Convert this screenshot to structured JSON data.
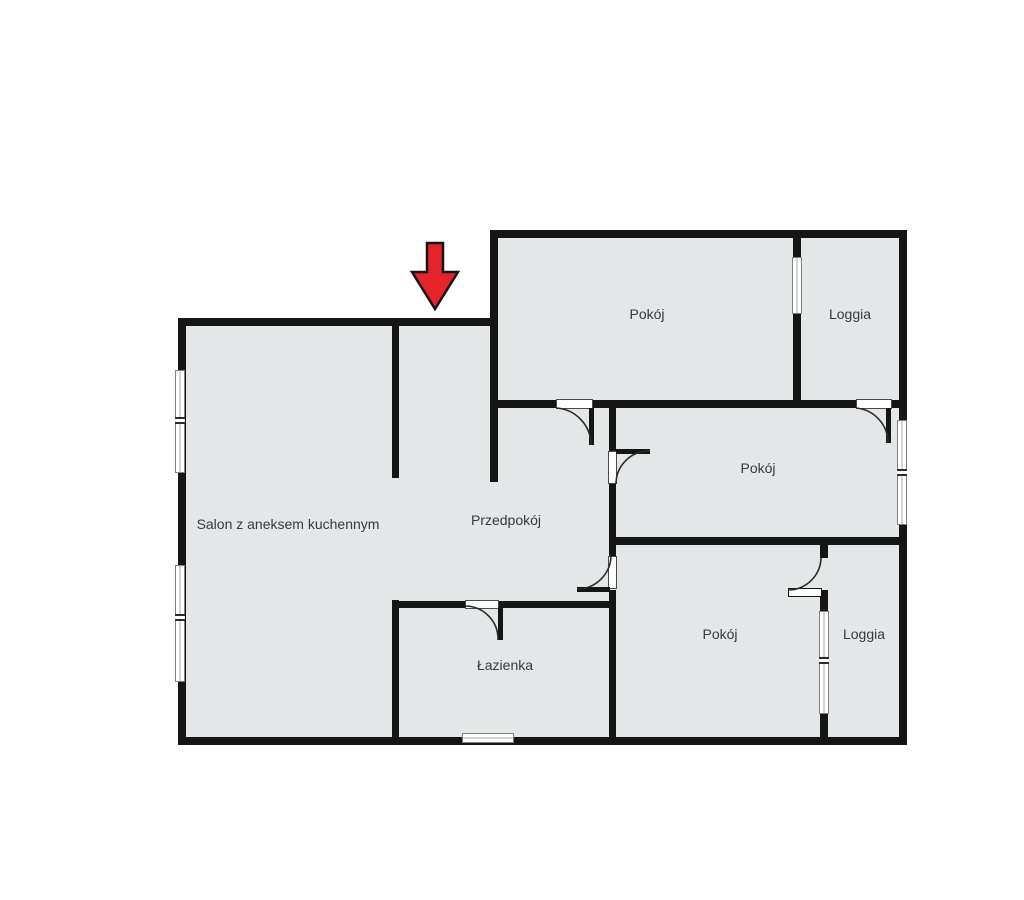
{
  "colors": {
    "background": "#ffffff",
    "floor": "#e4e7e8",
    "wall": "#151515",
    "label": "#35393d",
    "arc": "#2a2a2a",
    "window_border": "#808080",
    "door_border": "#4a4a4a",
    "arrow_fill": "#e5232b",
    "arrow_outline": "#151515"
  },
  "rooms": {
    "salon": {
      "label": "Salon z aneksem kuchennym"
    },
    "przedpokoj": {
      "label": "Przedpokój"
    },
    "lazienka": {
      "label": "Łazienka"
    },
    "pokoj_top": {
      "label": "Pokój"
    },
    "loggia_top": {
      "label": "Loggia"
    },
    "pokoj_middle": {
      "label": "Pokój"
    },
    "pokoj_bottom": {
      "label": "Pokój"
    },
    "loggia_bottom": {
      "label": "Loggia"
    }
  },
  "icons": {
    "entrance_arrow": {
      "name": "entrance-arrow-icon",
      "direction": "down",
      "color": "#e5232b"
    }
  }
}
